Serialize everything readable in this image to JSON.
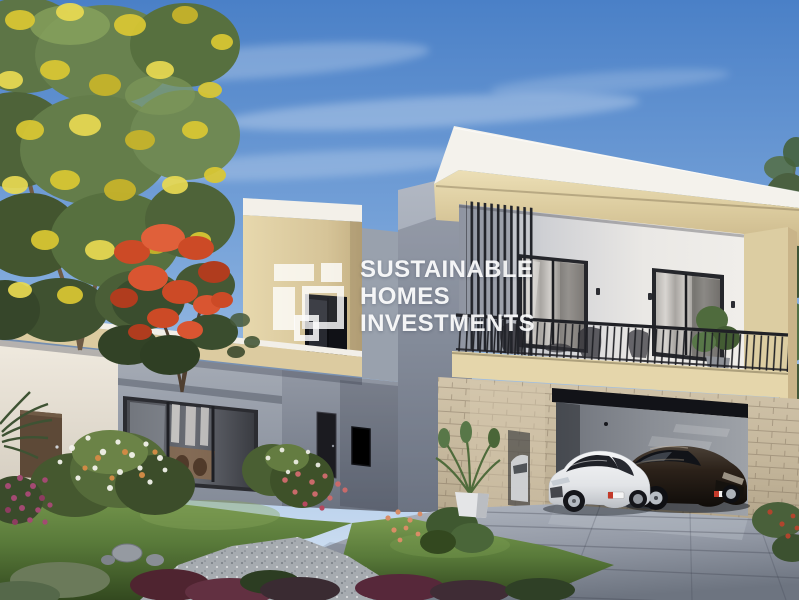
{
  "title": "Villa exterior rendering",
  "watermark": {
    "lines": [
      "SUSTAINABLE",
      "HOMES",
      "INVESTMENTS"
    ],
    "logo": "white-squares-monogram",
    "text_color": "#ffffff"
  },
  "scene": {
    "type": "architectural-rendering",
    "description": "Modern two-storey beige and white villa with framed upper floor, vertical louvres, black balcony railing, stone-clad double garage with a white and a dark sports car, landscaped front garden, yellow and red flowering trees under a blue sky",
    "objects": [
      "sky",
      "clouds",
      "yellow-flower-tree",
      "flame-tree",
      "pine-trees",
      "two-storey-block",
      "roof-slab",
      "facade-frame",
      "bedroom-window-left",
      "bedroom-window-right",
      "louvres",
      "balcony-railing",
      "balcony-furniture",
      "wall-sconces",
      "stone-cladding",
      "garage-opening",
      "white-sports-car",
      "dark-sports-car",
      "single-storey-wing",
      "living-room-window",
      "side-door",
      "entrance-door",
      "canopy-box",
      "driveway",
      "lawn",
      "gravel-bed",
      "rocks",
      "flower-bushes",
      "potted-plant",
      "palm-fronds"
    ]
  },
  "palette": {
    "sky_top": "#4a80c7",
    "sky_bottom": "#d8e5f4",
    "facade_beige": "#dccc9f",
    "roof_white": "#f4f2ec",
    "wall_gray": "#98a0ad",
    "stone": "#c3b59a",
    "railing_black": "#1f2024",
    "lawn_green": "#597a3a",
    "driveway_gray": "#949aa6",
    "tree_yellow": "#dbc833",
    "flame_red": "#cc4a27",
    "car_white": "#e9eaec",
    "car_dark": "#221b15"
  }
}
